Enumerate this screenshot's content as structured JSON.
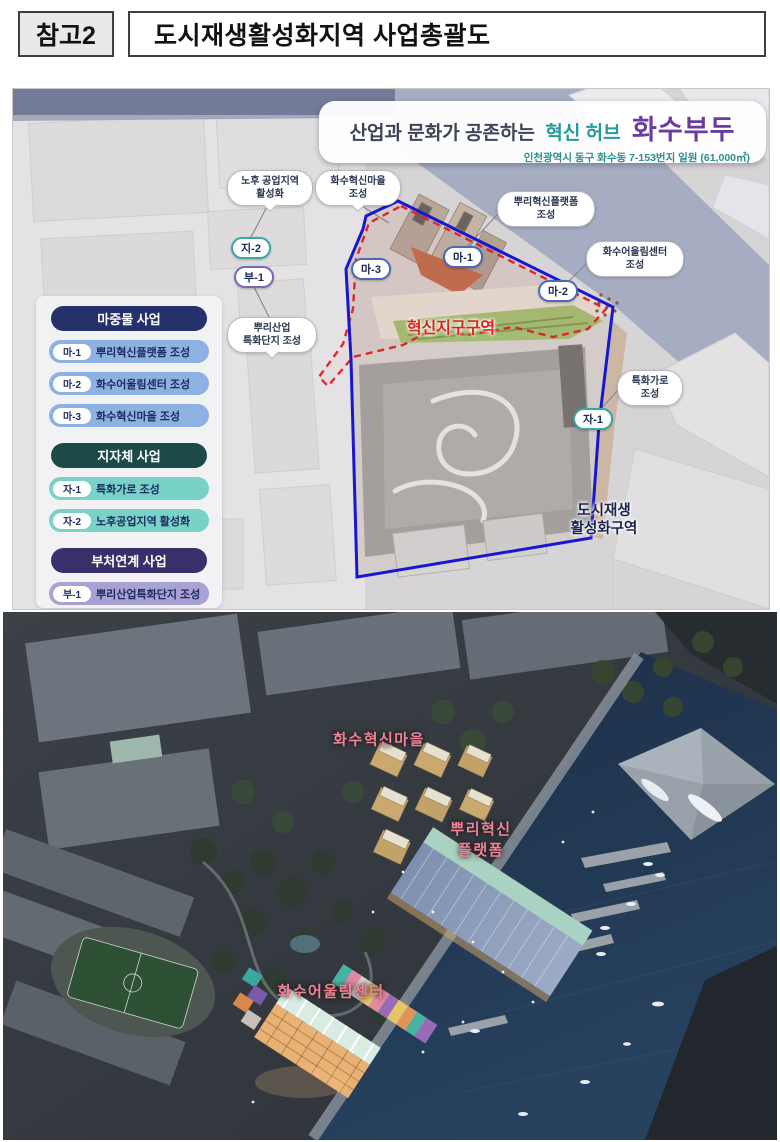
{
  "header": {
    "badge": "참고2",
    "title": "도시재생활성화지역  사업총괄도"
  },
  "map": {
    "title": {
      "prefix": "산업과 문화가 공존하는",
      "highlight": "혁신 허브",
      "name": "화수부두",
      "subtitle": "인천광역시 동구 화수동 7-153번지 일원 (61,000㎡)"
    },
    "colors": {
      "accent_teal": "#259a9b",
      "accent_purple": "#6a3ca0",
      "boundary_blue": "#1717cf",
      "boundary_red": "#e02828",
      "water": "#a6adc2"
    },
    "legend": {
      "sections": [
        {
          "title": "마중물 사업",
          "header_color": "#25316b",
          "item_color": "#8db1e2",
          "items": [
            {
              "code": "마-1",
              "label": "뿌리혁신플랫폼 조성"
            },
            {
              "code": "마-2",
              "label": "화수어울림센터 조성"
            },
            {
              "code": "마-3",
              "label": "화수혁신마을 조성"
            }
          ]
        },
        {
          "title": "지자체 사업",
          "header_color": "#1c4a49",
          "item_color": "#79d2c8",
          "items": [
            {
              "code": "자-1",
              "label": "특화가로 조성"
            },
            {
              "code": "자-2",
              "label": "노후공업지역 활성화"
            }
          ]
        },
        {
          "title": "부처연계 사업",
          "header_color": "#37306b",
          "item_color": "#a9a1d4",
          "items": [
            {
              "code": "부-1",
              "label": "뿌리산업특화단지 조성"
            }
          ]
        }
      ]
    },
    "callouts": [
      {
        "line1": "노후 공업지역",
        "line2": "활성화"
      },
      {
        "line1": "화수혁신마을",
        "line2": "조성"
      },
      {
        "line1": "뿌리혁신플랫폼",
        "line2": "조성"
      },
      {
        "line1": "화수어울림센터",
        "line2": "조성"
      },
      {
        "line1": "뿌리산업",
        "line2": "특화단지 조성"
      },
      {
        "line1": "특화가로",
        "line2": "조성"
      }
    ],
    "badges": [
      {
        "code": "지-2"
      },
      {
        "code": "부-1"
      },
      {
        "code": "마-3"
      },
      {
        "code": "마-1"
      },
      {
        "code": "마-2"
      },
      {
        "code": "자-1"
      }
    ],
    "zone_labels": {
      "innovation": "혁신지구구역",
      "regen_line1": "도시재생",
      "regen_line2": "활성화구역"
    }
  },
  "render": {
    "label_color": "#ef8391",
    "labels": {
      "village": "화수혁신마을",
      "platform_line1": "뿌리혁신",
      "platform_line2": "플랫폼",
      "center": "화수어울림센터"
    }
  }
}
